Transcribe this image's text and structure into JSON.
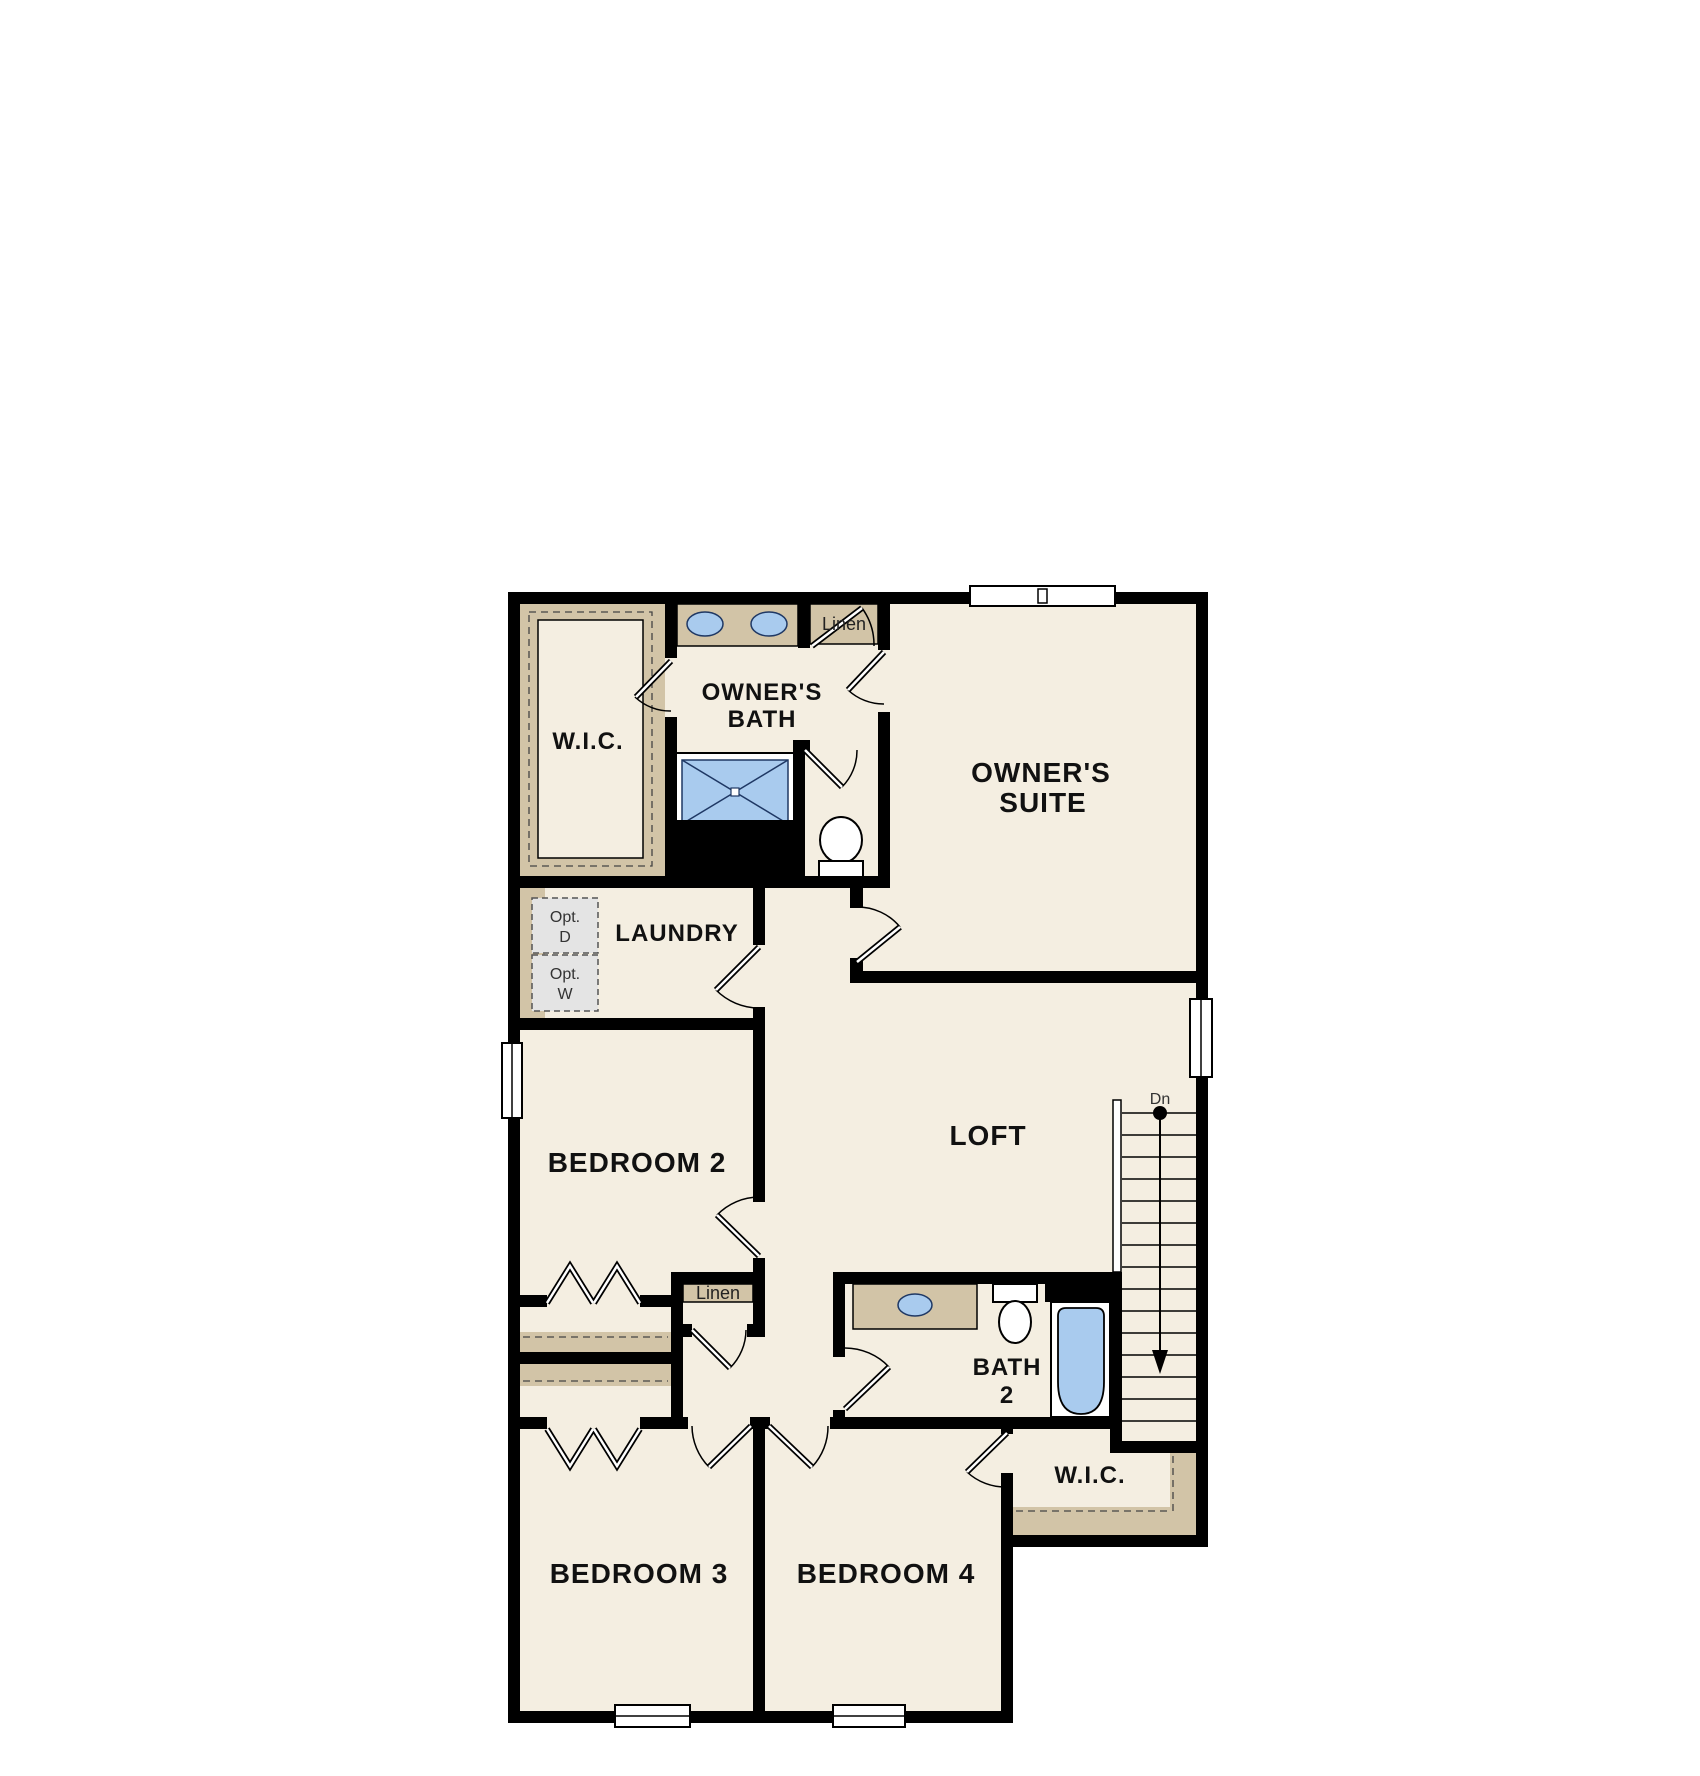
{
  "rooms": {
    "owners_wic": {
      "label": "W.I.C."
    },
    "owners_bath": {
      "label_line1": "OWNER'S",
      "label_line2": "BATH"
    },
    "linen_upper": {
      "label": "Linen"
    },
    "owners_suite": {
      "label_line1": "OWNER'S",
      "label_line2": "SUITE"
    },
    "laundry": {
      "label": "LAUNDRY"
    },
    "optional_dryer": {
      "label_line1": "Opt.",
      "label_line2": "D"
    },
    "optional_washer": {
      "label_line1": "Opt.",
      "label_line2": "W"
    },
    "bedroom2": {
      "label": "BEDROOM 2"
    },
    "loft": {
      "label": "LOFT"
    },
    "stairs": {
      "label": "Dn"
    },
    "linen_lower": {
      "label": "Linen"
    },
    "bath2": {
      "label_line1": "BATH",
      "label_line2": "2"
    },
    "hall_wic": {
      "label": "W.I.C."
    },
    "bedroom3": {
      "label": "BEDROOM 3"
    },
    "bedroom4": {
      "label": "BEDROOM 4"
    }
  },
  "colors": {
    "floor": "#f4eee1",
    "wall": "#000000",
    "shelf-tan": "#d2c4a7",
    "fixture-blue": "#a9cbee",
    "fixture-line": "#1f3864",
    "option-gray": "#e4e4e4",
    "label-text": "#111111"
  }
}
